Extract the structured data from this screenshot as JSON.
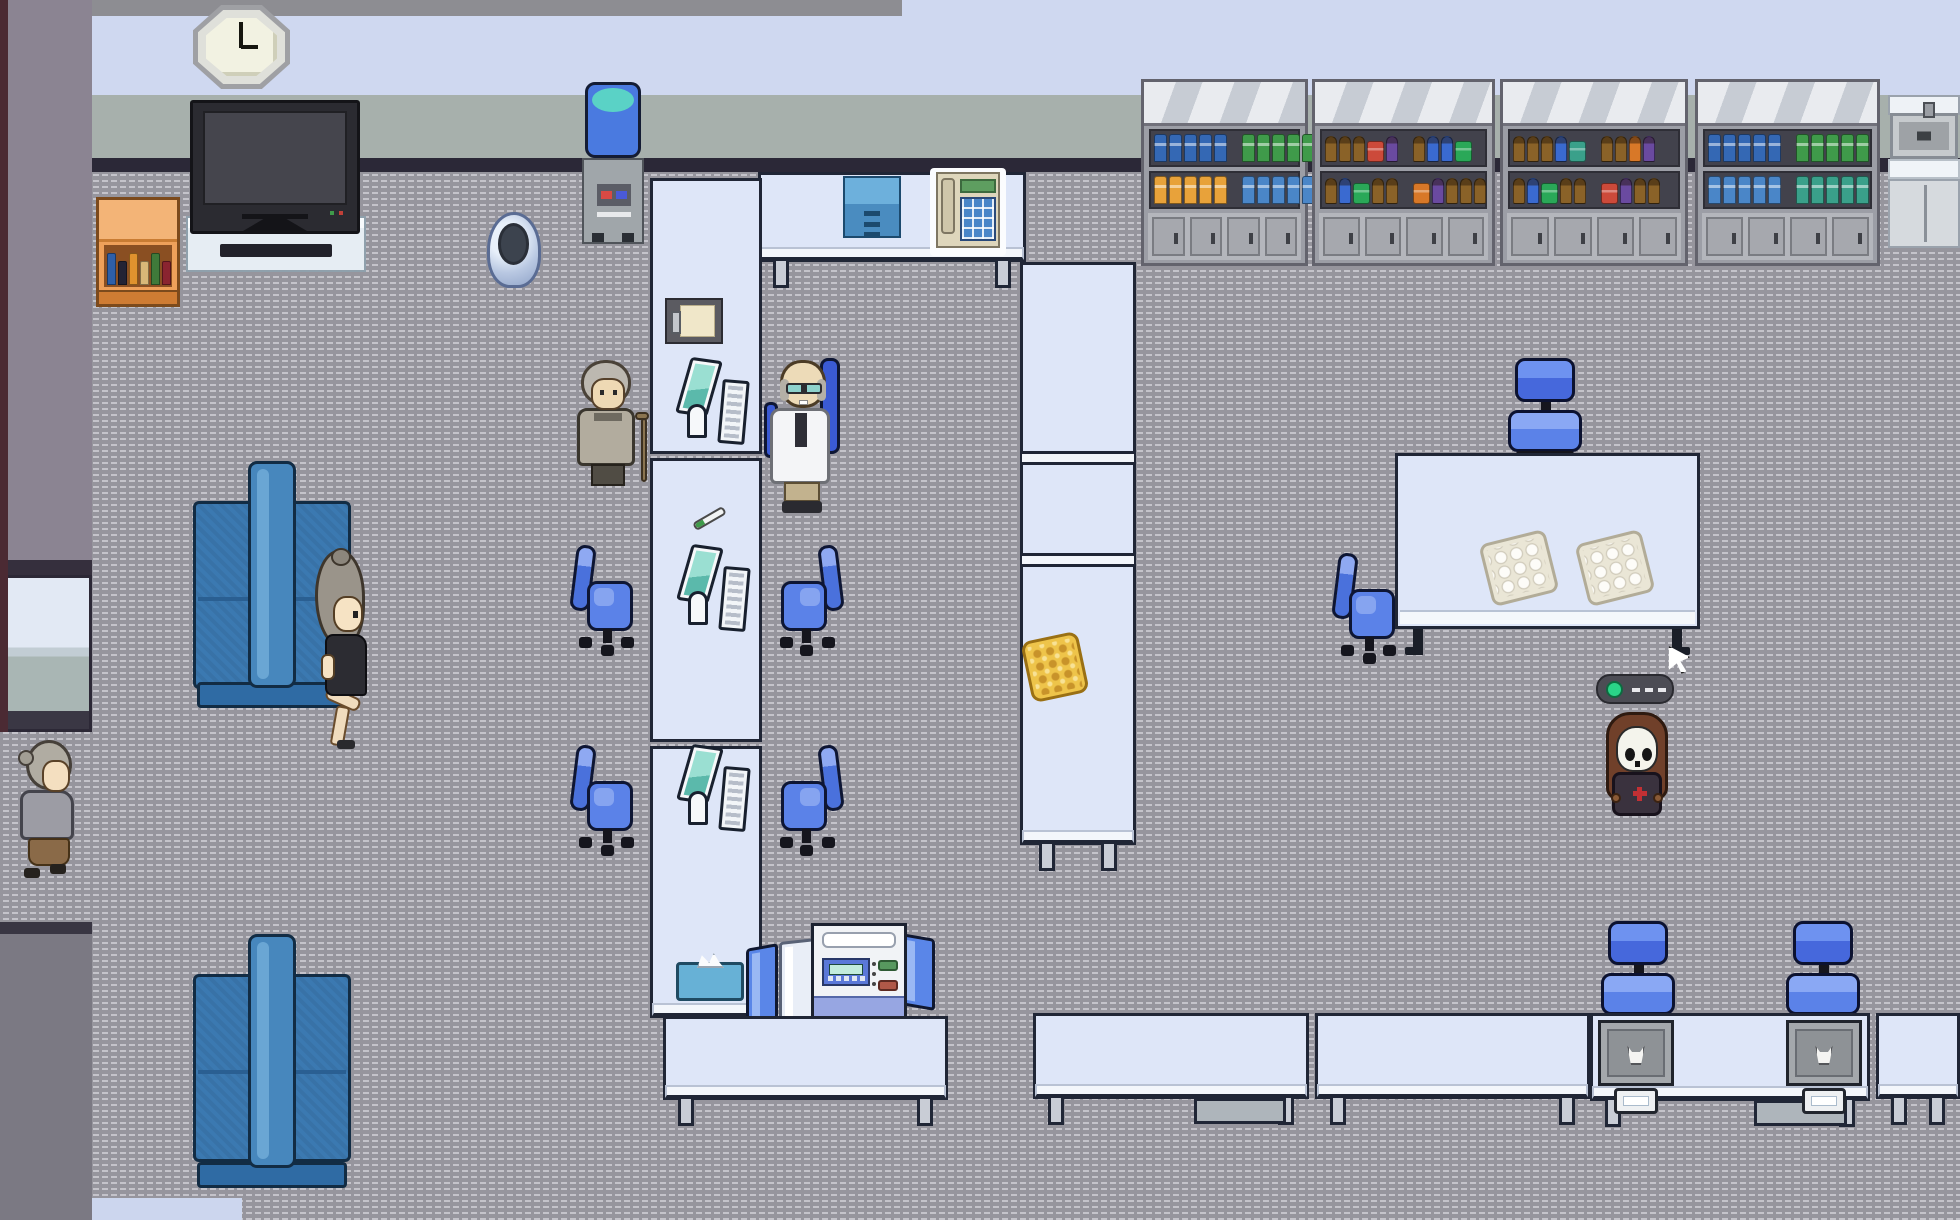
{
  "palette": {
    "floor": "#96959d",
    "floor_dash": "#c4c3ca",
    "wall_upper": "#cfd8f0",
    "wall_band": "#a7b0ac",
    "wall_trim": "#2b2837",
    "wall_left": "#8b8492",
    "wall_edge": "#4b2a33",
    "counter": "#dee6f8",
    "counter_border": "#202636",
    "chair_blue": "#5b82e8",
    "couch_blue": "#3b79b1",
    "accent_teal": "#5ad2c6",
    "screen_teal": "#9adfd2",
    "led_green": "#2ad488",
    "waffle_gold": "#eec44a"
  },
  "bookshelf_books": [
    "#2e5fa8",
    "#232334",
    "#e0922e",
    "#d8b878",
    "#3f7a3a",
    "#8a2430"
  ],
  "entities": [
    {
      "t": "shelf",
      "n": "supply-shelf-1",
      "i": true,
      "x": 1141,
      "y": 79,
      "w": 167,
      "h": 187,
      "rows": [
        [
          {
            "c": "#3468b4",
            "n": 5,
            "k": "f"
          },
          {
            "s": 1
          },
          {
            "c": "#3f9a4a",
            "n": 5,
            "k": "f"
          }
        ],
        [
          {
            "c": "#e8a23a",
            "n": 5,
            "k": "f"
          },
          {
            "s": 1
          },
          {
            "c": "#4a86c8",
            "n": 5,
            "k": "f"
          }
        ]
      ]
    },
    {
      "t": "shelf",
      "n": "supply-shelf-2",
      "i": true,
      "x": 1312,
      "y": 79,
      "w": 183,
      "h": 187,
      "rows": [
        [
          {
            "c": "#8a6228",
            "n": 3,
            "k": "b"
          },
          {
            "c": "#cc4a3a",
            "n": 1,
            "k": "x"
          },
          {
            "c": "#6a4aa0",
            "n": 1,
            "k": "b"
          },
          {
            "s": 1
          },
          {
            "c": "#8a6228",
            "n": 1,
            "k": "b"
          },
          {
            "c": "#3a6ad0",
            "n": 2,
            "k": "b"
          },
          {
            "c": "#2aa858",
            "n": 1,
            "k": "x"
          }
        ],
        [
          {
            "c": "#8a6228",
            "n": 1,
            "k": "b"
          },
          {
            "c": "#3a6ad0",
            "n": 1,
            "k": "b"
          },
          {
            "c": "#2aa858",
            "n": 1,
            "k": "x"
          },
          {
            "c": "#8a6228",
            "n": 2,
            "k": "b"
          },
          {
            "s": 1
          },
          {
            "c": "#d87828",
            "n": 1,
            "k": "x"
          },
          {
            "c": "#6a4aa0",
            "n": 1,
            "k": "b"
          },
          {
            "c": "#8a6228",
            "n": 3,
            "k": "b"
          }
        ]
      ]
    },
    {
      "t": "shelf",
      "n": "supply-shelf-3",
      "i": true,
      "x": 1500,
      "y": 79,
      "w": 188,
      "h": 187,
      "rows": [
        [
          {
            "c": "#8a6228",
            "n": 3,
            "k": "b"
          },
          {
            "c": "#3a6ad0",
            "n": 1,
            "k": "b"
          },
          {
            "c": "#3aa08a",
            "n": 1,
            "k": "x"
          },
          {
            "s": 1
          },
          {
            "c": "#8a6228",
            "n": 2,
            "k": "b"
          },
          {
            "c": "#d87828",
            "n": 1,
            "k": "b"
          },
          {
            "c": "#6a4aa0",
            "n": 1,
            "k": "b"
          }
        ],
        [
          {
            "c": "#8a6228",
            "n": 1,
            "k": "b"
          },
          {
            "c": "#3a6ad0",
            "n": 1,
            "k": "b"
          },
          {
            "c": "#2aa858",
            "n": 1,
            "k": "x"
          },
          {
            "c": "#8a6228",
            "n": 2,
            "k": "b"
          },
          {
            "s": 1
          },
          {
            "c": "#cc4a3a",
            "n": 1,
            "k": "x"
          },
          {
            "c": "#6a4aa0",
            "n": 1,
            "k": "b"
          },
          {
            "c": "#8a6228",
            "n": 2,
            "k": "b"
          }
        ]
      ]
    },
    {
      "t": "shelf",
      "n": "supply-shelf-4",
      "i": true,
      "x": 1695,
      "y": 79,
      "w": 185,
      "h": 187,
      "rows": [
        [
          {
            "c": "#3468b4",
            "n": 5,
            "k": "f"
          },
          {
            "s": 1
          },
          {
            "c": "#3f9a4a",
            "n": 5,
            "k": "f"
          }
        ],
        [
          {
            "c": "#4a86c8",
            "n": 5,
            "k": "f"
          },
          {
            "s": 1
          },
          {
            "c": "#3aa08a",
            "n": 5,
            "k": "f"
          }
        ]
      ]
    },
    {
      "t": "sink",
      "n": "sink-unit",
      "i": true,
      "x": 1888,
      "y": 95,
      "w": 72,
      "h": 153
    },
    {
      "t": "clock",
      "n": "wall-clock",
      "i": false,
      "x": 193,
      "y": 5,
      "w": 97,
      "h": 84
    },
    {
      "t": "tvstand",
      "n": "tv-stand",
      "i": false,
      "x": 186,
      "y": 216,
      "w": 180,
      "h": 56
    },
    {
      "t": "tv",
      "n": "television",
      "i": false,
      "x": 190,
      "y": 100,
      "w": 170,
      "h": 134
    },
    {
      "t": "bookshelf",
      "n": "bookshelf",
      "i": true,
      "x": 96,
      "y": 197,
      "w": 84,
      "h": 110
    },
    {
      "t": "watercooler",
      "n": "water-cooler",
      "i": true,
      "x": 580,
      "y": 82,
      "w": 66,
      "h": 168
    },
    {
      "t": "desk",
      "n": "reception-desk",
      "i": false,
      "x": 758,
      "y": 172,
      "w": 268,
      "h": 90
    },
    {
      "t": "drawer",
      "n": "drawer-unit",
      "i": true,
      "x": 843,
      "y": 176,
      "w": 58,
      "h": 62
    },
    {
      "t": "phone",
      "n": "desk-phone",
      "i": true,
      "x": 930,
      "y": 168,
      "w": 76,
      "h": 88
    },
    {
      "t": "counter",
      "n": "exam-counter-upper",
      "i": false,
      "x": 650,
      "y": 178,
      "w": 112,
      "h": 276
    },
    {
      "t": "counter",
      "n": "exam-counter-middle",
      "i": false,
      "x": 650,
      "y": 458,
      "w": 112,
      "h": 284
    },
    {
      "t": "counter",
      "n": "exam-counter-lower",
      "i": false,
      "x": 650,
      "y": 746,
      "w": 112,
      "h": 272,
      "v": "cap"
    },
    {
      "t": "counter",
      "n": "long-counter-right",
      "i": false,
      "x": 1020,
      "y": 262,
      "w": 116,
      "h": 583,
      "v": "tall"
    },
    {
      "t": "clipboard",
      "n": "clipboard",
      "i": true,
      "x": 665,
      "y": 298,
      "w": 58,
      "h": 46
    },
    {
      "t": "station",
      "n": "computer-station-1",
      "i": true,
      "x": 683,
      "y": 356,
      "w": 64,
      "h": 92
    },
    {
      "t": "thermo",
      "n": "thermometer",
      "i": true,
      "x": 690,
      "y": 500,
      "w": 40,
      "h": 38
    },
    {
      "t": "station",
      "n": "computer-station-2",
      "i": true,
      "x": 684,
      "y": 543,
      "w": 64,
      "h": 95
    },
    {
      "t": "station",
      "n": "computer-station-3",
      "i": true,
      "x": 684,
      "y": 743,
      "w": 64,
      "h": 95
    },
    {
      "t": "tissue",
      "n": "tissue-box",
      "i": true,
      "x": 676,
      "y": 953,
      "w": 68,
      "h": 48
    },
    {
      "t": "waffle",
      "n": "food-item",
      "i": true,
      "x": 1026,
      "y": 636,
      "w": 58,
      "h": 62,
      "tf": "rotate(-12deg)"
    },
    {
      "t": "trash",
      "n": "trash-bin",
      "i": true,
      "x": 487,
      "y": 212,
      "w": 54,
      "h": 76
    },
    {
      "t": "couch",
      "n": "waiting-couch-top",
      "i": true,
      "x": 193,
      "y": 461,
      "w": 158,
      "h": 247
    },
    {
      "t": "womansit",
      "n": "woman-patient-sitting",
      "i": true,
      "x": 291,
      "y": 548,
      "w": 82,
      "h": 200
    },
    {
      "t": "oldman",
      "n": "elderly-man-with-cane",
      "i": true,
      "x": 573,
      "y": 360,
      "w": 74,
      "h": 132
    },
    {
      "t": "doctor",
      "n": "doctor",
      "i": true,
      "x": 764,
      "y": 358,
      "w": 78,
      "h": 156
    },
    {
      "t": "chairr",
      "n": "office-chair",
      "i": true,
      "x": 573,
      "y": 543,
      "w": 64,
      "h": 114
    },
    {
      "t": "chairl",
      "n": "office-chair",
      "i": true,
      "x": 777,
      "y": 543,
      "w": 64,
      "h": 114,
      "tf": "scaleX(-1)"
    },
    {
      "t": "chairr",
      "n": "office-chair",
      "i": true,
      "x": 573,
      "y": 743,
      "w": 64,
      "h": 118
    },
    {
      "t": "chairl",
      "n": "office-chair",
      "i": true,
      "x": 777,
      "y": 743,
      "w": 64,
      "h": 118,
      "tf": "scaleX(-1)"
    },
    {
      "t": "oldwoman",
      "n": "elderly-woman-walking",
      "i": true,
      "x": 14,
      "y": 740,
      "w": 76,
      "h": 142
    },
    {
      "t": "couch",
      "n": "waiting-couch-bottom",
      "i": true,
      "x": 193,
      "y": 934,
      "w": 158,
      "h": 254
    },
    {
      "t": "chairf",
      "n": "office-chair",
      "i": true,
      "x": 1508,
      "y": 358,
      "w": 74,
      "h": 100
    },
    {
      "t": "table",
      "n": "treatment-table",
      "i": false,
      "x": 1395,
      "y": 453,
      "w": 305,
      "h": 202
    },
    {
      "t": "tray",
      "n": "specimen-tray",
      "i": true,
      "x": 1485,
      "y": 536,
      "w": 68,
      "h": 64,
      "tf": "rotate(-14deg)"
    },
    {
      "t": "tray",
      "n": "specimen-tray",
      "i": true,
      "x": 1581,
      "y": 536,
      "w": 68,
      "h": 64,
      "tf": "rotate(-14deg)"
    },
    {
      "t": "chairr",
      "n": "office-chair",
      "i": true,
      "x": 1335,
      "y": 551,
      "w": 64,
      "h": 112
    },
    {
      "t": "remote",
      "n": "remote-device",
      "i": true,
      "x": 1596,
      "y": 674,
      "w": 78,
      "h": 30
    },
    {
      "t": "skull",
      "n": "skull-masked-character",
      "i": true,
      "x": 1604,
      "y": 708,
      "w": 66,
      "h": 112
    },
    {
      "t": "cursor",
      "n": "mouse-cursor",
      "i": false,
      "x": 1666,
      "y": 646,
      "w": 24,
      "h": 28
    },
    {
      "t": "panelb",
      "n": "privacy-panel",
      "i": false,
      "x": 746,
      "y": 946,
      "w": 32,
      "h": 76,
      "tf": "skewY(-10deg)"
    },
    {
      "t": "panelw",
      "n": "privacy-panel",
      "i": false,
      "x": 779,
      "y": 940,
      "w": 38,
      "h": 82,
      "tf": "skewY(-6deg)"
    },
    {
      "t": "panelb",
      "n": "privacy-panel",
      "i": false,
      "x": 901,
      "y": 936,
      "w": 34,
      "h": 72,
      "tf": "skewY(10deg)"
    },
    {
      "t": "printer",
      "n": "lab-analyzer",
      "i": true,
      "x": 811,
      "y": 923,
      "w": 96,
      "h": 110
    },
    {
      "t": "desk",
      "n": "work-desk",
      "i": false,
      "x": 663,
      "y": 1016,
      "w": 285,
      "h": 84
    },
    {
      "t": "desk",
      "n": "work-desk",
      "i": false,
      "x": 1033,
      "y": 1013,
      "w": 276,
      "h": 86,
      "v": "shelf"
    },
    {
      "t": "desk",
      "n": "work-desk",
      "i": false,
      "x": 1315,
      "y": 1013,
      "w": 275,
      "h": 86
    },
    {
      "t": "chairf",
      "n": "office-chair",
      "i": true,
      "x": 1601,
      "y": 921,
      "w": 74,
      "h": 99
    },
    {
      "t": "chairf",
      "n": "office-chair",
      "i": true,
      "x": 1786,
      "y": 921,
      "w": 74,
      "h": 99
    },
    {
      "t": "desk",
      "n": "lab-desk",
      "i": false,
      "x": 1590,
      "y": 1013,
      "w": 280,
      "h": 88,
      "v": "shelf"
    },
    {
      "t": "device",
      "n": "lab-sink-station",
      "i": true,
      "x": 1598,
      "y": 1020,
      "w": 76,
      "h": 94
    },
    {
      "t": "device",
      "n": "lab-sink-station",
      "i": true,
      "x": 1786,
      "y": 1020,
      "w": 76,
      "h": 94
    },
    {
      "t": "desk",
      "n": "work-desk",
      "i": false,
      "x": 1876,
      "y": 1013,
      "w": 84,
      "h": 86
    }
  ]
}
